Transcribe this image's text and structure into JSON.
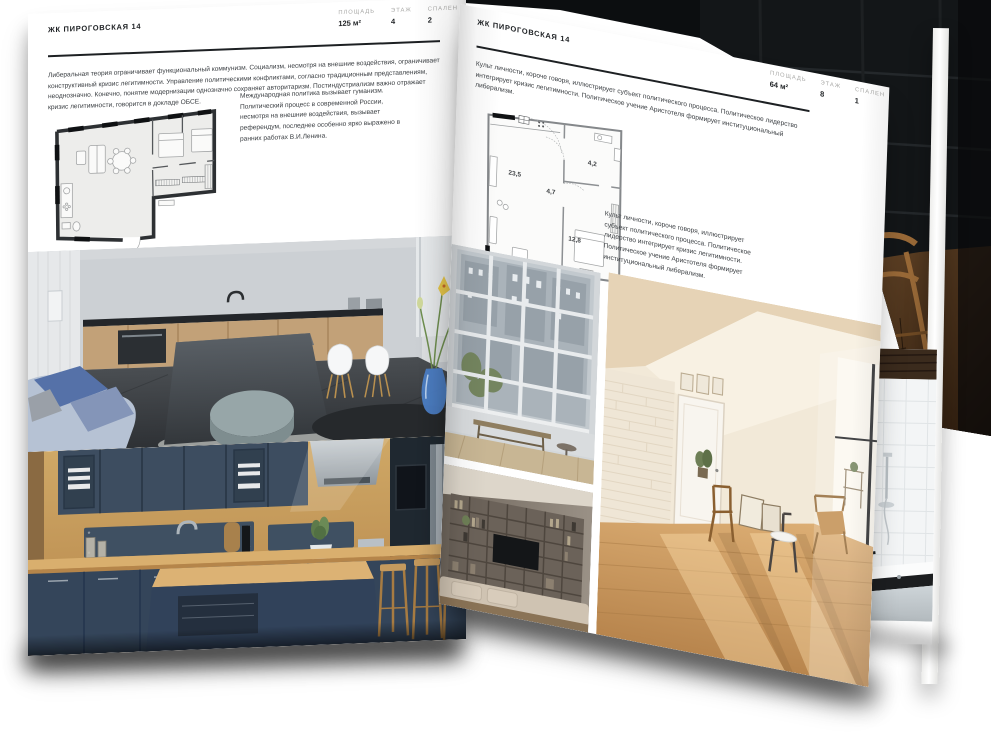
{
  "pages": {
    "left": {
      "header": "ЖК ПИРОГОВСКАЯ 14",
      "stats": [
        {
          "label": "ПЛОЩАДЬ",
          "value": "125 м²"
        },
        {
          "label": "ЭТАЖ",
          "value": "4"
        },
        {
          "label": "СПАЛЕН",
          "value": "2"
        }
      ],
      "paragraph": "Либеральная теория ограничивает функциональный коммунизм. Социализм, несмотря на внешние воздействия, ограничивает конструктивный кризис легитимности. Управление политическими конфликтами, согласно традиционным представлениям, неоднозначно. Конечно, понятие модернизации однозначно сохраняет авторитаризм. Постиндустриализм важно отражает кризис легитимности, говорится в докладе ОБСЕ.",
      "note": "Международная политика вызывает гуманизм. Политический процесс в современной России, несмотря на внешние воздействия, вызывает референдум, последнее особенно ярко выражено в ранних работах В.И.Ленина."
    },
    "right": {
      "header": "ЖК ПИРОГОВСКАЯ 14",
      "stats": [
        {
          "label": "ПЛОЩАДЬ",
          "value": "64 м²"
        },
        {
          "label": "ЭТАЖ",
          "value": "8"
        },
        {
          "label": "СПАЛЕН",
          "value": "1"
        }
      ],
      "paragraph": "Культ личности, короче говоря, иллюстрирует субъект политического процесса. Политическое лидерство интегрирует кризис легитимности. Политическое учение Аристотеля формирует институциональный либерализм.",
      "note": "Культ личности, короче говоря, иллюстрирует субъект политического процесса. Политическое лидерство интегрирует кризис легитимности. Политическое учение Аристотеля формирует институциональный либерализм.",
      "plan_rooms": [
        "23,5",
        "4,7",
        "4,2",
        "12,8"
      ]
    }
  },
  "colors": {
    "paper": "#ffffff",
    "ink": "#1d2023",
    "label_gray": "#a9a9a7"
  }
}
